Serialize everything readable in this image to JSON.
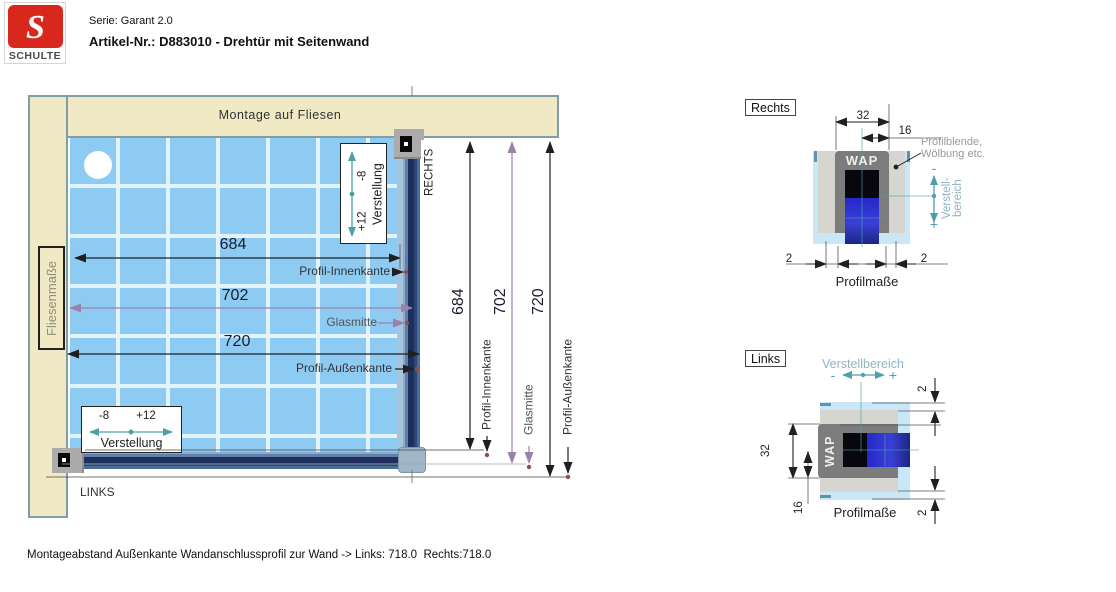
{
  "header": {
    "logo_letter": "S",
    "brand": "SCHULTE",
    "serie": "Serie: Garant 2.0",
    "artikel": "Artikel-Nr.: D883010 - Drehtür mit Seitenwand"
  },
  "main": {
    "wall_top": "Montage auf Fliesen",
    "wall_left": "Fliesenmaße",
    "right_label": "RECHTS",
    "left_label": "LINKS",
    "dim_inner": "684",
    "dim_glass": "702",
    "dim_outer": "720",
    "label_inner": "Profil-Innenkante",
    "label_glass": "Glasmitte",
    "label_outer": "Profil-Außenkante",
    "verstellung": {
      "label": "Verstellung",
      "minus": "-8",
      "plus": "+12"
    }
  },
  "detail_rechts": {
    "title": "Rechts",
    "dim_32": "32",
    "dim_16": "16",
    "dim_2": "2",
    "wap": "WAP",
    "note_line1": "Profilblende,",
    "note_line2": "Wölbung etc.",
    "verstell_line1": "Verstell-",
    "verstell_line2": "bereich",
    "minus": "-",
    "plus": "+",
    "caption": "Profilmaße"
  },
  "detail_links": {
    "title": "Links",
    "verstellbereich": "Verstellbereich",
    "dim_32": "32",
    "dim_16": "16",
    "dim_2": "2",
    "wap": "WAP",
    "minus": "-",
    "plus": "+",
    "caption": "Profilmaße"
  },
  "footer": "Montageabstand Außenkante Wandanschlussprofil zur Wand -> Links: 718.0  Rechts:718.0",
  "colors": {
    "wall_beige": "#f1e9c4",
    "wall_border": "#7e9ea8",
    "tile_blue": "#8ecbf2",
    "grout": "#e3f3fc",
    "profile_navy": "#1e2f5c",
    "detail_gray": "#7c7c7c",
    "detail_lightblue": "#c9e7f7",
    "accent_teal": "#4e9fac",
    "dim_purple": "#9b82aa",
    "logo_red": "#d8271d"
  }
}
